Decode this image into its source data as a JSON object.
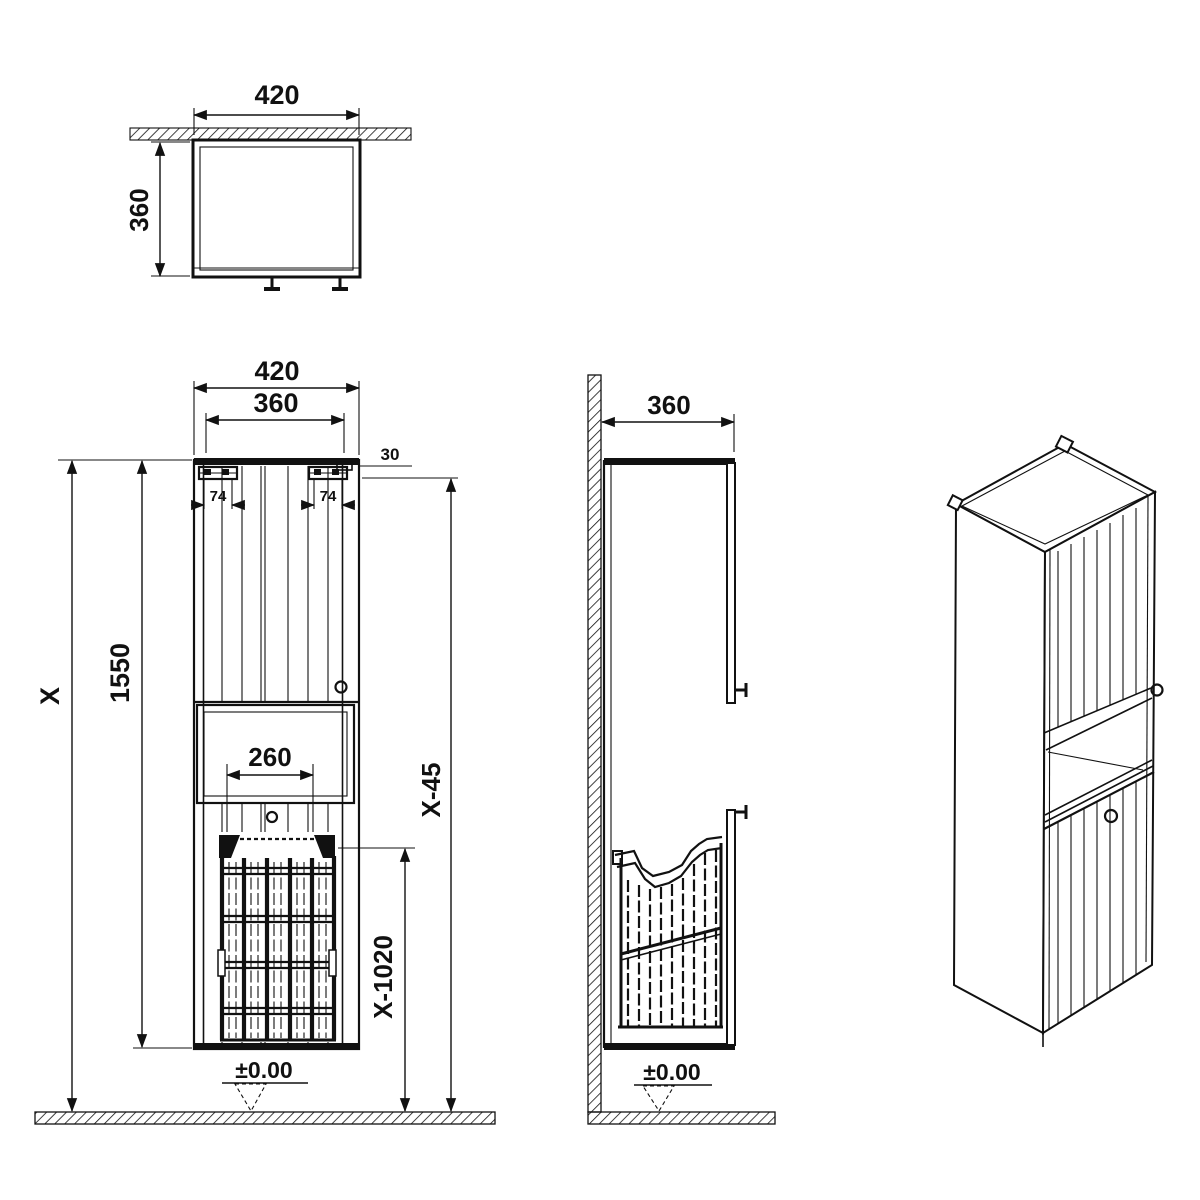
{
  "meta": {
    "type": "technical-drawing",
    "subject": "tall wall-mounted bathroom cabinet with open niche and laundry basket",
    "line_color": "#111111",
    "background_color": "#ffffff"
  },
  "views": {
    "top": {
      "label": "top-view",
      "width": "420",
      "depth": "360"
    },
    "front": {
      "label": "front-view",
      "overall_width": "420",
      "door_width": "360",
      "top_offset": "30",
      "hinge_left": "74",
      "hinge_right": "74",
      "height_total": "X",
      "height_cabinet": "1550",
      "basket_width": "260",
      "height_hinge_to_floor": "X-45",
      "height_basket_to_floor": "X-1020",
      "floor_datum": "±0.00"
    },
    "side": {
      "label": "side-view",
      "depth": "360",
      "floor_datum": "±0.00"
    },
    "iso": {
      "label": "perspective-view"
    }
  }
}
